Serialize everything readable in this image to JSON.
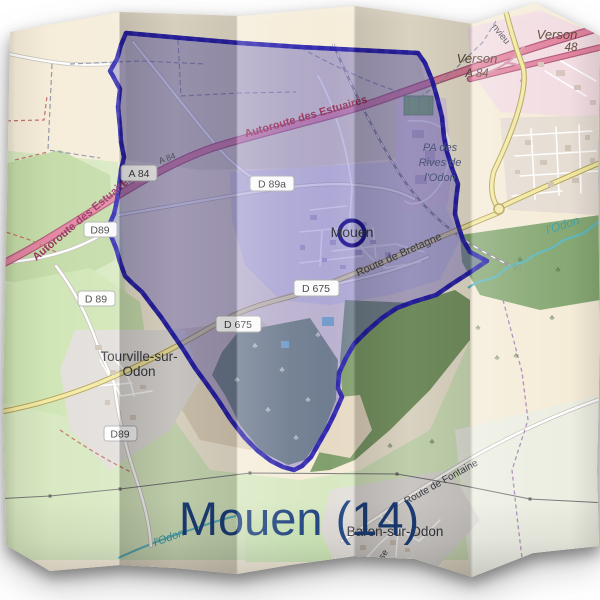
{
  "title": "Mouen (14)",
  "labels": {
    "mouen_town": "Mouen",
    "tourville_line1": "Tourville-sur-",
    "tourville_line2": "Odon",
    "baron": "Baron-sur-Odon",
    "verson_ne_name": "Verson",
    "verson_ne_ref": "48",
    "verson_w_name": "Verson",
    "verson_w_ref": "A 84",
    "autoroute_sw": "Autoroute des Estuaires",
    "autoroute_ne": "Autoroute des Estuaires",
    "a84_on_road": "A 84",
    "pa_zone_line1": "PA des",
    "pa_zone_line2": "Rives de",
    "pa_zone_line3": "l'Odon",
    "route_bretagne": "Route de Bretagne",
    "route_fontaine": "Route de Fontaine",
    "street_eglise_partial": "lise",
    "street_nvieu_partial": "nvieu",
    "river_odon_east": "l'Odon",
    "river_odon_west": "l'Odon",
    "elevation": "90"
  },
  "badges": {
    "a84": "A 84",
    "d89a": "D 89a",
    "d89_north": "D89",
    "d89_west": "D 89",
    "d89_south": "D89",
    "d675_east": "D 675",
    "d675_west": "D 675"
  },
  "colors": {
    "title": "#1d4280",
    "boundary": "#2a22ae",
    "boundary_fill": "rgba(92,84,192,0.40)",
    "motorway": "#e2849f",
    "primary_road": "#f2e9a2",
    "water": "#5fb8c0",
    "autoroute_label": "#97305c"
  }
}
